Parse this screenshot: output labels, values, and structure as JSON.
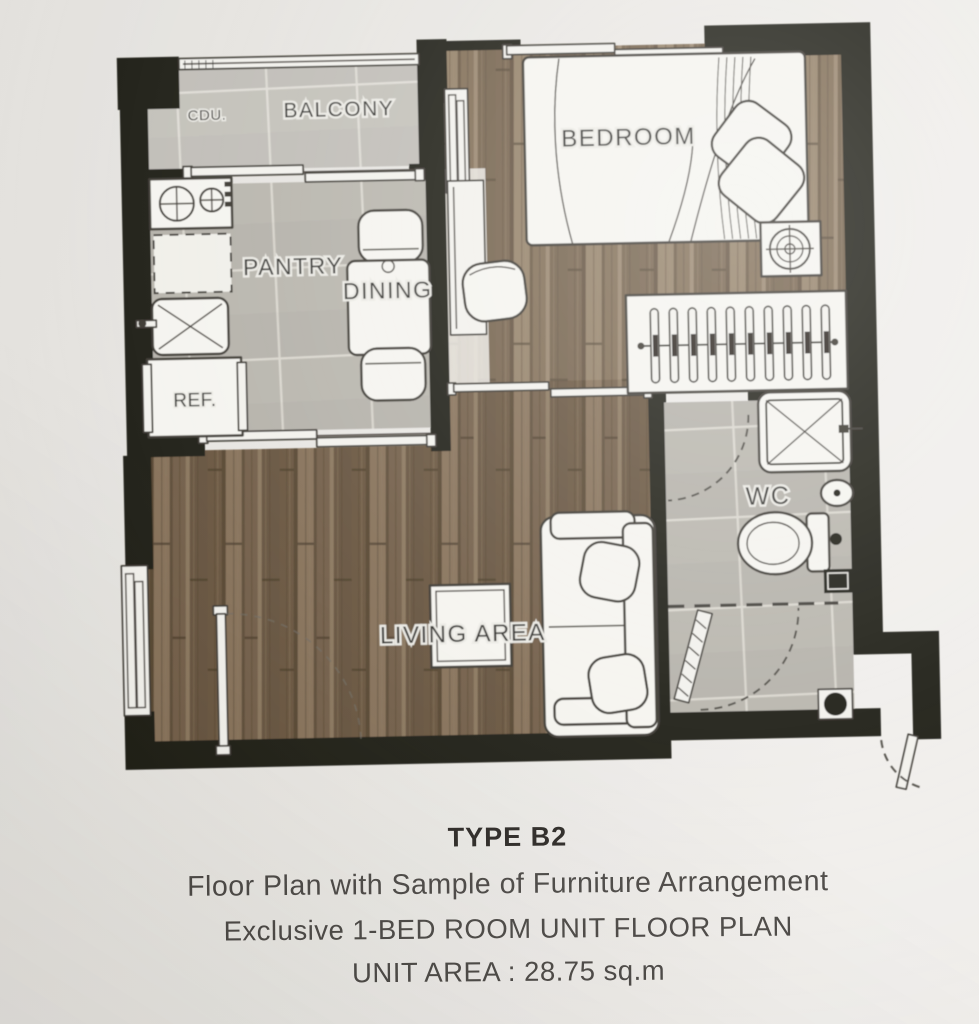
{
  "labels": {
    "cdu": "CDU.",
    "balcony": "BALCONY",
    "bedroom": "BEDROOM",
    "pantry": "PANTRY",
    "dining": "DINING",
    "ref": "REF.",
    "wc": "WC",
    "living": "LIVING AREA"
  },
  "caption": {
    "title": "TYPE B2",
    "line1": "Floor Plan with Sample of Furniture Arrangement",
    "line2": "Exclusive 1-BED ROOM UNIT FLOOR PLAN",
    "line3": "UNIT AREA : 28.75 sq.m"
  },
  "unit_area_sqm": "28.75",
  "unit_type": "B2",
  "colors": {
    "paper": "#e7e5e1",
    "wall": "#17130e",
    "tile": "#b6b3aa",
    "tile_joint": "#d9d6cd",
    "wood_base": "#7b664e",
    "wood_dark": "#55432e",
    "wood_light": "#8f7a5f",
    "furniture_fill": "#f5f4ef",
    "outline": "#34302a",
    "label_text": "#2c2a26",
    "caption_text": "#464340"
  }
}
